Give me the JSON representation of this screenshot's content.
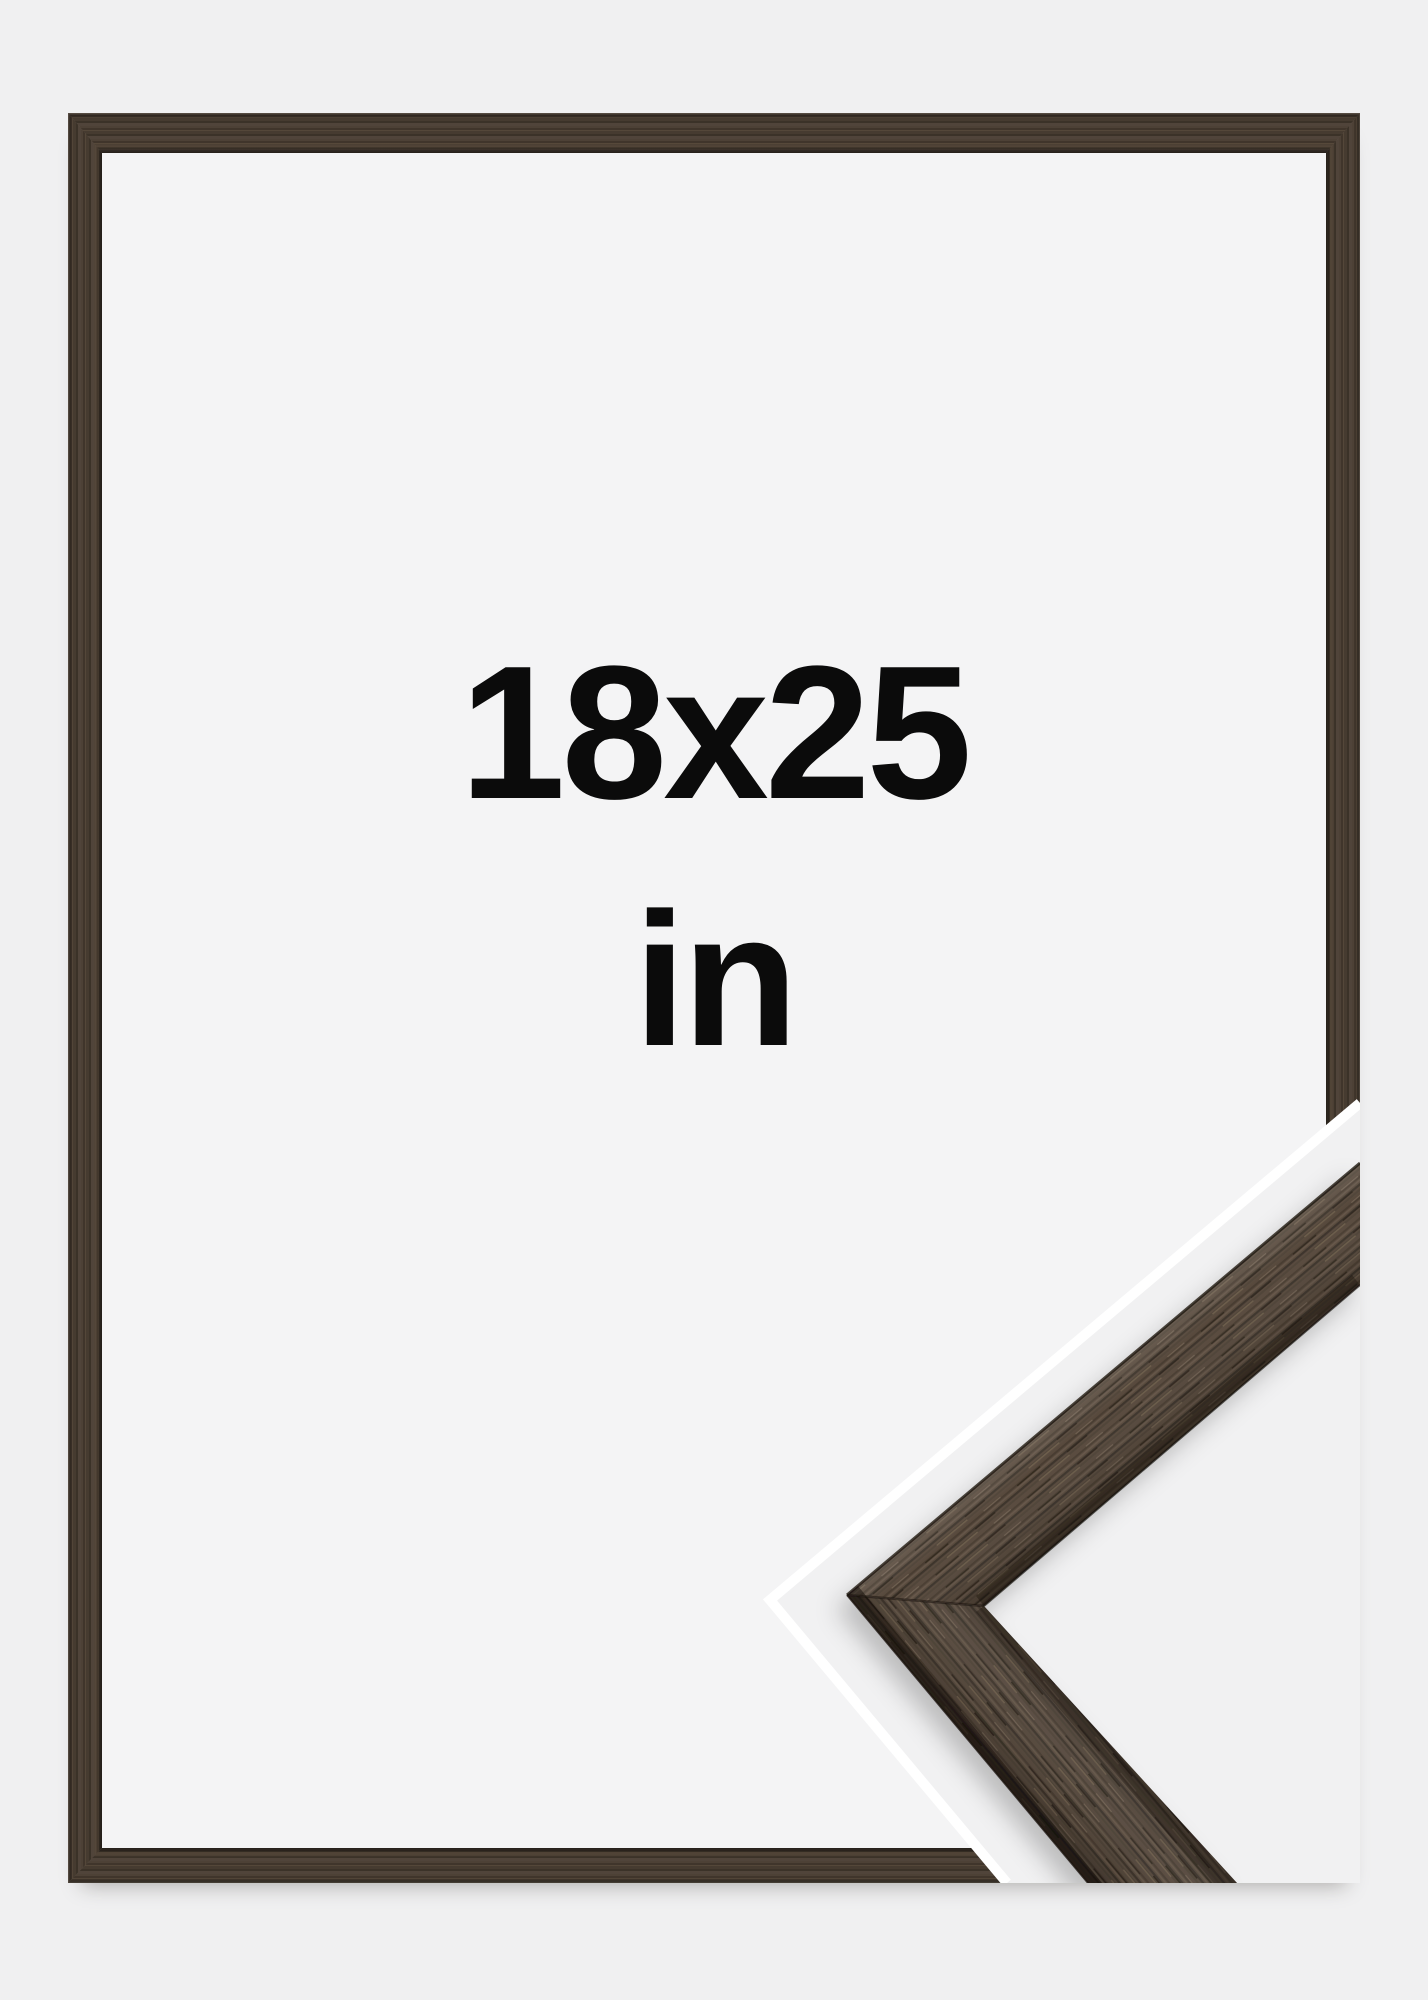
{
  "product_image": {
    "size_label": {
      "dimensions": "18x25",
      "unit": "in"
    },
    "frame": {
      "material": "dark-brown-wood",
      "wood_color": "#483d32",
      "wood_highlight": "#57493c",
      "wood_shadow": "#2e2720"
    },
    "mat_color": "#f4f4f5",
    "background_color": "#f0f0f1",
    "detail_overlay": {
      "type": "frame-corner-close-up",
      "outline_color": "#ffffff"
    }
  }
}
